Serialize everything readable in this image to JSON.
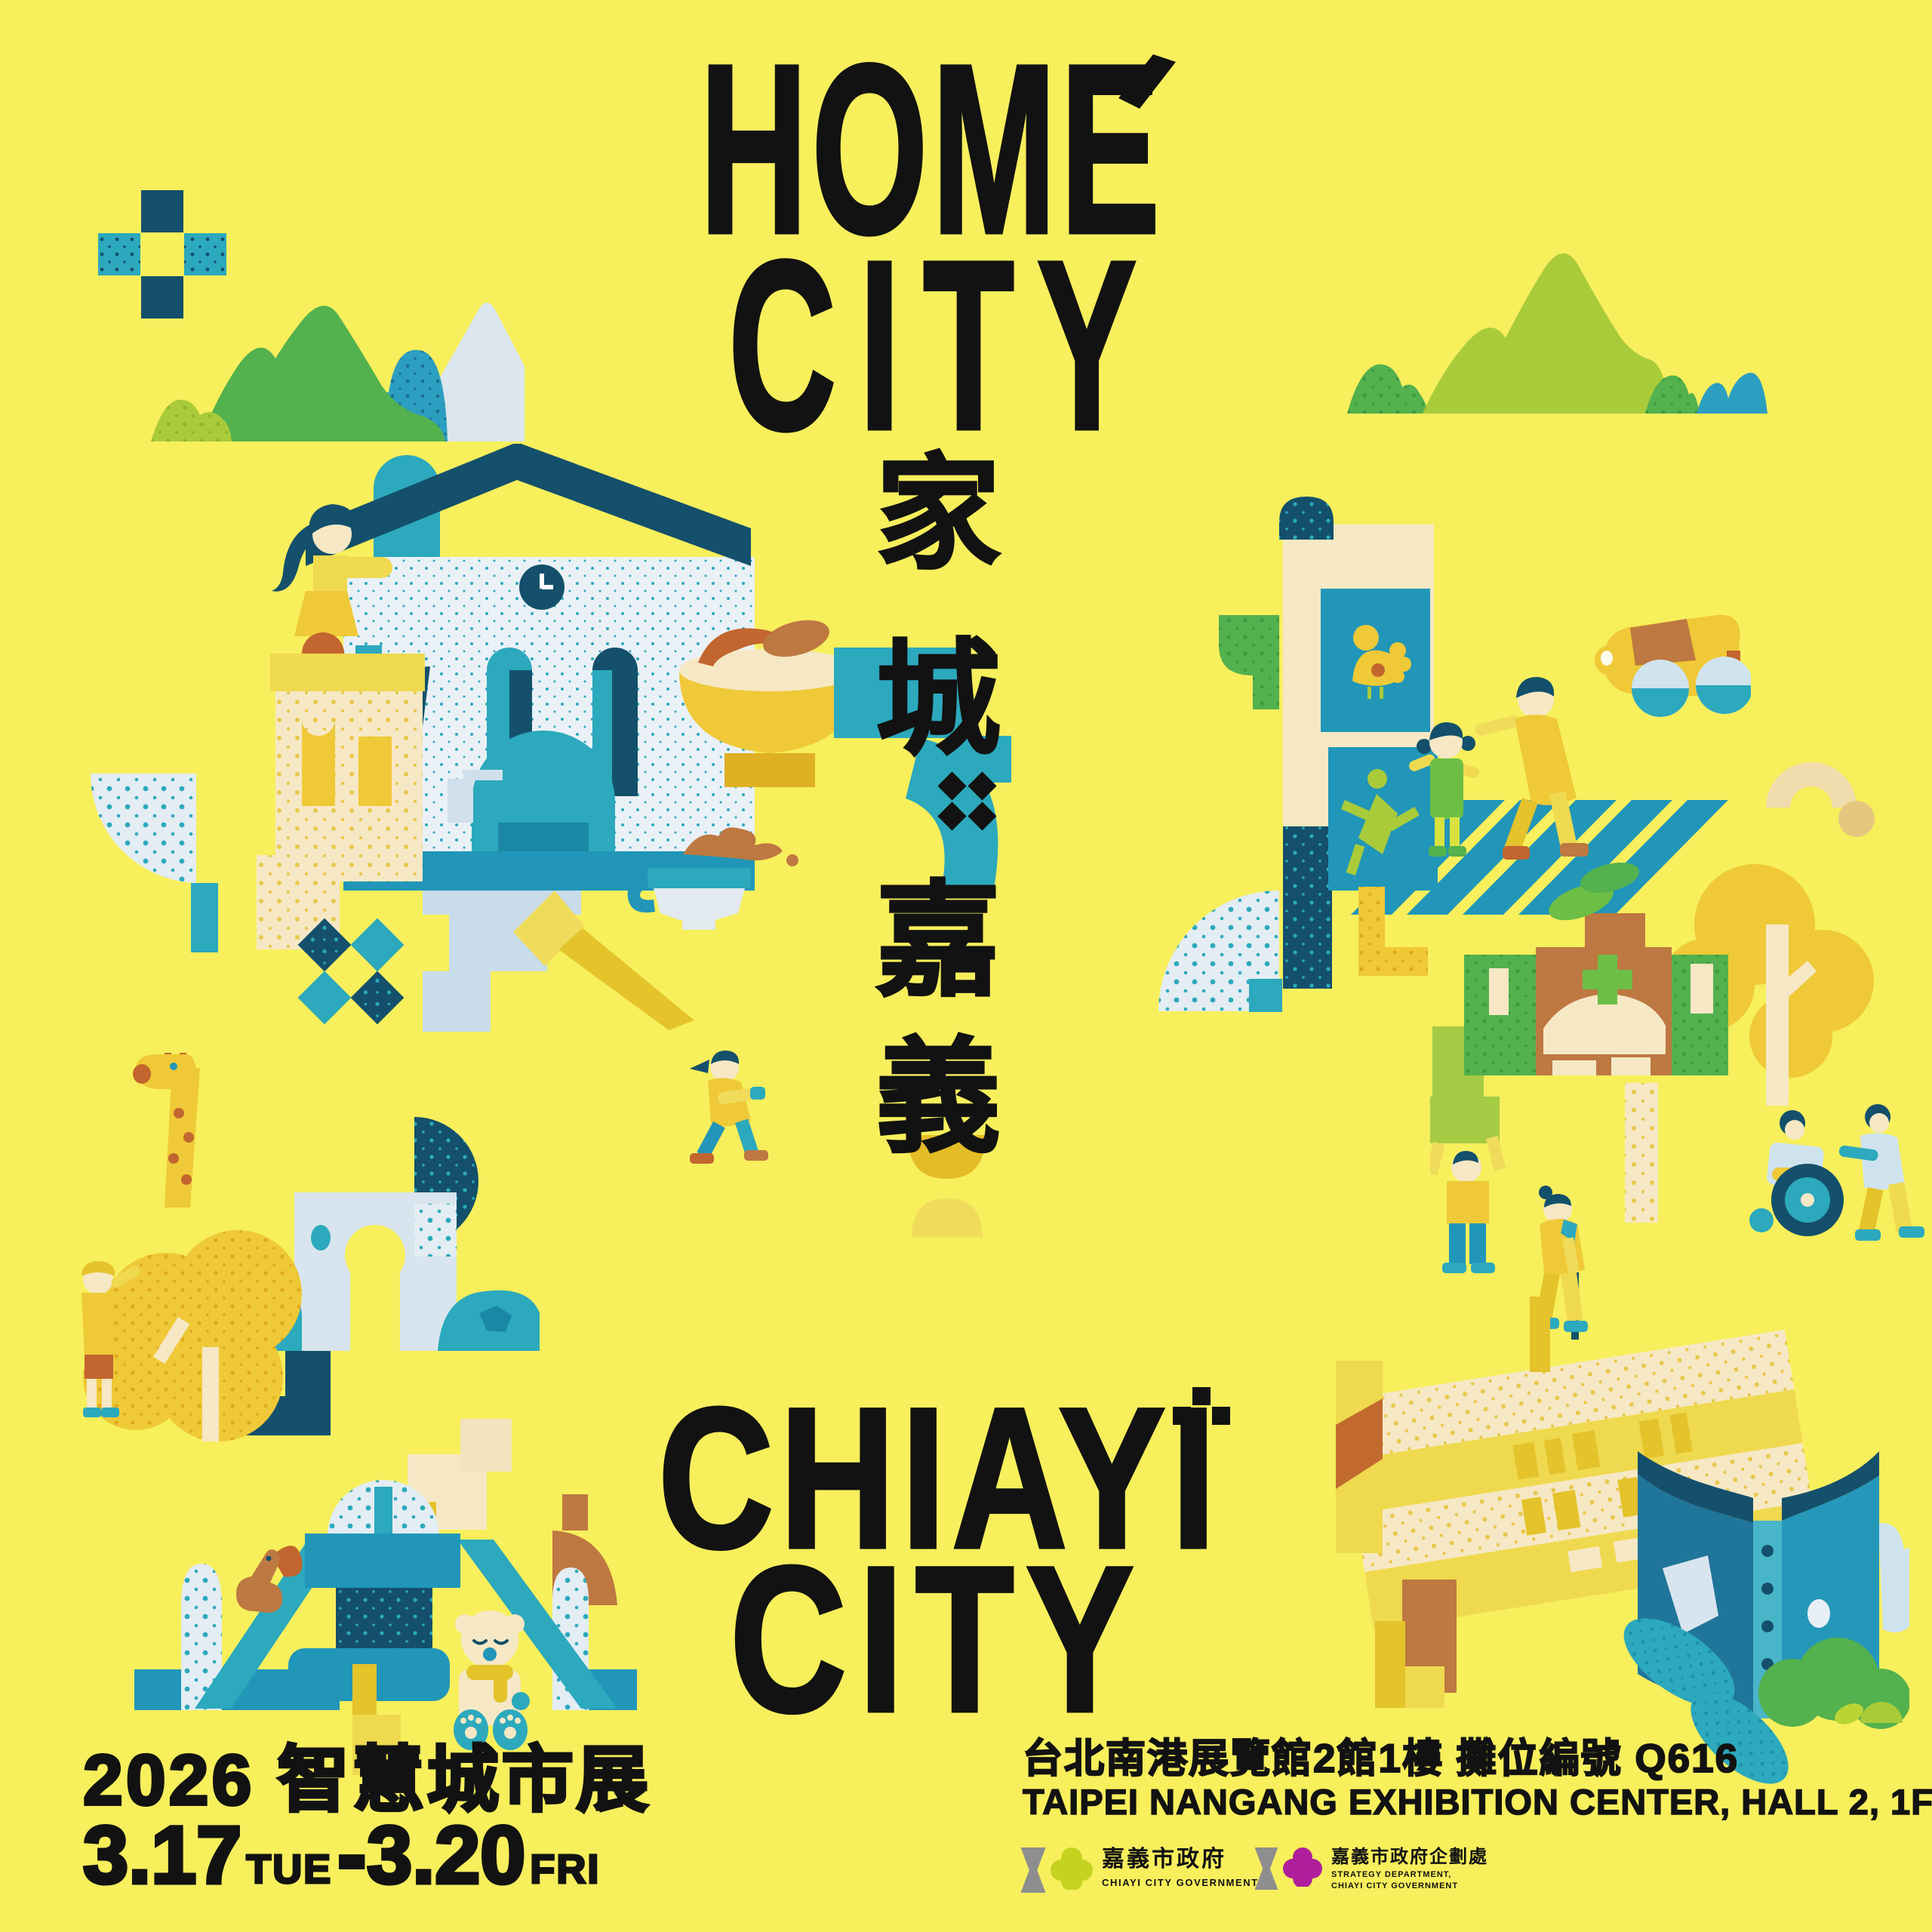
{
  "poster": {
    "background_color": "#F7EF5C",
    "ink_color": "#121212",
    "title_top": {
      "line1": "HOME",
      "line2": "CITY"
    },
    "vertical_title": {
      "char1": "家",
      "char2": "城",
      "separator": "::",
      "char3": "嘉",
      "char4": "義"
    },
    "title_bottom": {
      "line1": "CHIAYI",
      "line2": "CITY"
    },
    "event_info": {
      "expo_title": "2026 智慧城市展",
      "date_range": {
        "start_date": "3.17",
        "start_day": "TUE",
        "separator": "-",
        "end_date": "3.20",
        "end_day": "FRI"
      }
    },
    "venue": {
      "line_zh": "台北南港展覽館2館1樓  攤位編號 Q616",
      "line_en": "TAIPEI NANGANG EXHIBITION CENTER, HALL 2, 1F"
    },
    "logos": {
      "city_government": {
        "name_zh": "嘉義市政府",
        "name_en": "CHIAYI CITY GOVERNMENT",
        "hourglass_color": "#8E8E8E",
        "flower_color": "#C5D320"
      },
      "strategy_department": {
        "name_zh": "嘉義市政府企劃處",
        "name_en_line1": "STRATEGY DEPARTMENT,",
        "name_en_line2": "CHIAYI CITY GOVERNMENT",
        "hourglass_color": "#8E8E8E",
        "flower_color": "#AF1F9B"
      }
    },
    "palette": {
      "navy": "#14506B",
      "teal": "#2CA9BD",
      "teal_dark": "#1B87A6",
      "light_blue": "#D9E5EE",
      "green": "#53B14E",
      "lime": "#A9CB3A",
      "yellow": "#EFC937",
      "mustard": "#E4C32B",
      "cream": "#F6E8C5",
      "brown": "#BE7841",
      "rust": "#C2652E"
    },
    "illustrations": [
      {
        "name": "pixel-cross-icon",
        "label": "pixel plus cross"
      },
      {
        "name": "mountains-left-icon",
        "label": "green mountain range"
      },
      {
        "name": "mountains-right-icon",
        "label": "lime mountain range"
      },
      {
        "name": "museum-scene",
        "label": "historic clock-tower building, statue and turkey rice bowl"
      },
      {
        "name": "crosswalk-scene",
        "label": "sign banners, family on zebra crossing, yellow car"
      },
      {
        "name": "fan-diamonds-icon",
        "label": "dotted fan and diamond tiles"
      },
      {
        "name": "teacup-icon",
        "label": "tea cup with splash"
      },
      {
        "name": "kite-icon",
        "label": "yellow arrow kite"
      },
      {
        "name": "giraffe-park-scene",
        "label": "giraffe, tree, visitor and arch gate"
      },
      {
        "name": "walking-person-icon",
        "label": "walking traveler"
      },
      {
        "name": "hospital-scene",
        "label": "hospital, hedge, elder with cane, wheelchair pair"
      },
      {
        "name": "arch-domes-icon",
        "label": "tan arch and dot"
      },
      {
        "name": "teal-fan-icon",
        "label": "dotted quarter fan"
      },
      {
        "name": "bowls-icon",
        "label": "stacked bowls"
      },
      {
        "name": "playground-scene",
        "label": "slide playground with squirrel and bear"
      },
      {
        "name": "library-book-scene",
        "label": "art museum building with giant open book and bush"
      },
      {
        "name": "home-accent-icon",
        "label": "accent mark over HOME"
      },
      {
        "name": "chiayi-sparkle-icon",
        "label": "pixel sparkle beside CHIAYI"
      }
    ]
  }
}
